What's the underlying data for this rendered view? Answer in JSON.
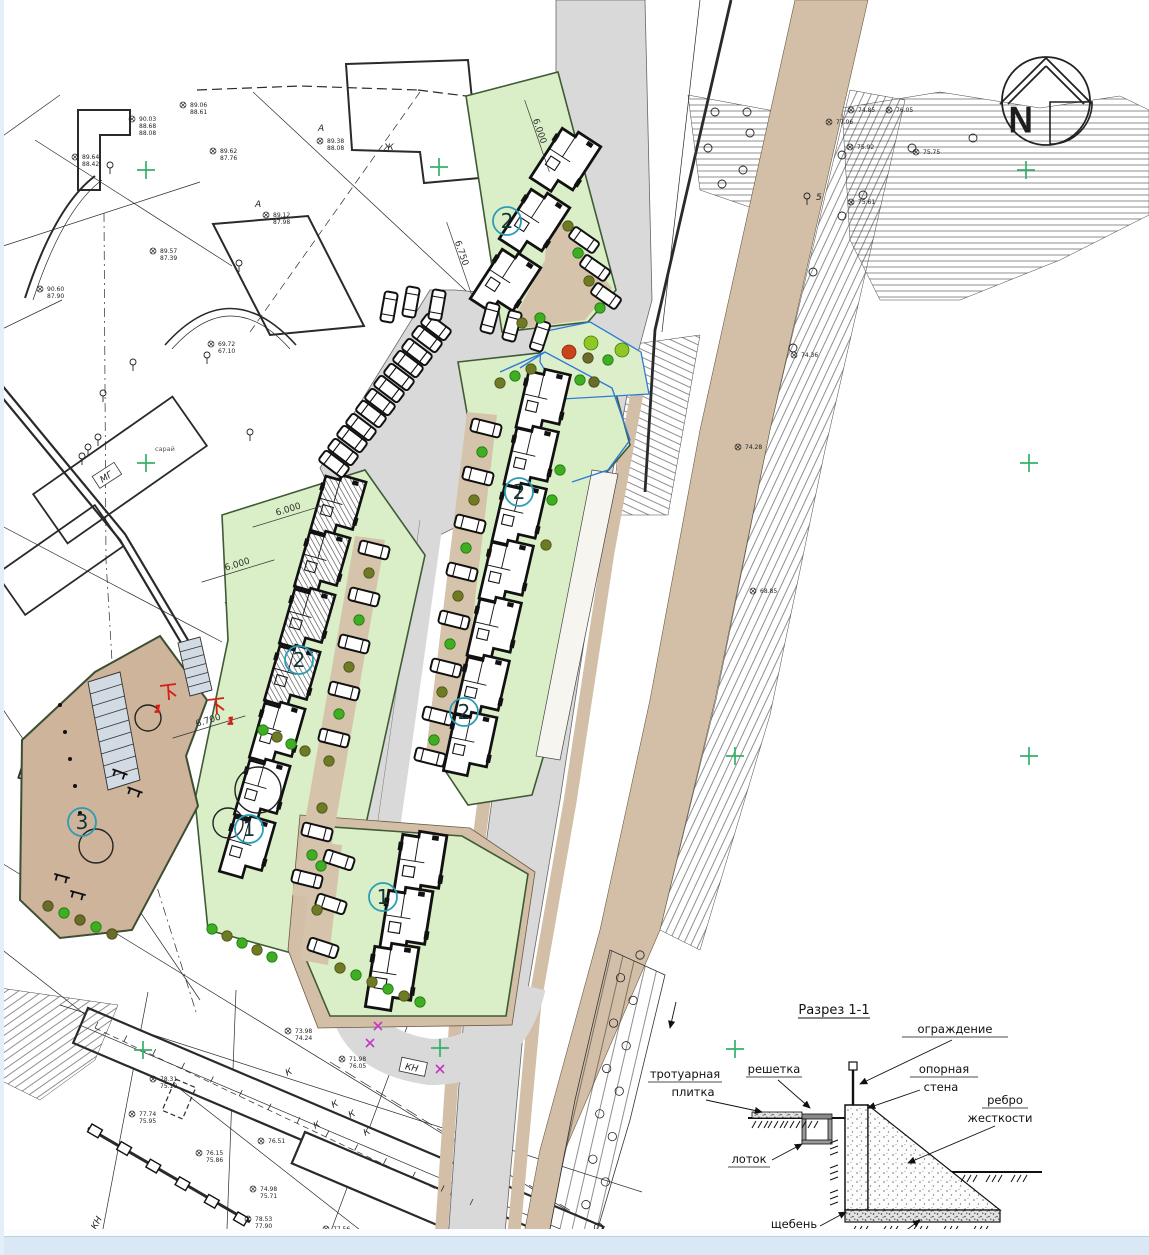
{
  "plan": {
    "north_label": "N",
    "unit_markers": [
      "2",
      "2",
      "2",
      "2",
      "1",
      "1",
      "3"
    ],
    "section_cut_marks": [
      "1",
      "1"
    ],
    "dimension_labels": [
      "6.000",
      "6.750",
      "6.000",
      "6.000",
      "6.700"
    ],
    "site_texts": {
      "zh": "Ж",
      "a1": "А",
      "a2": "А",
      "kn_box": "КН",
      "kn_slope": "КН",
      "mg": "МГ",
      "shed": "сарай",
      "tree_mark": "5"
    },
    "k_letters": [
      "К",
      "К",
      "К",
      "К",
      "К"
    ],
    "elevations": [
      {
        "lines": [
          "89.06",
          "88.61"
        ]
      },
      {
        "lines": [
          "90.03",
          "88.68",
          "88.08"
        ]
      },
      {
        "lines": [
          "89.64",
          "88.42"
        ]
      },
      {
        "lines": [
          "89.62",
          "87.76"
        ]
      },
      {
        "lines": [
          "89.38",
          "88.08"
        ]
      },
      {
        "lines": [
          "89.57",
          "87.39"
        ]
      },
      {
        "lines": [
          "89.12",
          "87.98"
        ]
      },
      {
        "lines": [
          "90.60",
          "87.90"
        ]
      },
      {
        "lines": [
          "69.72",
          "67.10"
        ]
      },
      {
        "lines": [
          "74.85"
        ]
      },
      {
        "lines": [
          "76.05"
        ]
      },
      {
        "lines": [
          "77.06"
        ]
      },
      {
        "lines": [
          "75.92"
        ]
      },
      {
        "lines": [
          "75.75"
        ]
      },
      {
        "lines": [
          "75.61"
        ]
      },
      {
        "lines": [
          "74.36"
        ]
      },
      {
        "lines": [
          "74.28"
        ]
      },
      {
        "lines": [
          "68.85"
        ]
      },
      {
        "lines": [
          "78.31",
          "75.10"
        ]
      },
      {
        "lines": [
          "77.74",
          "75.95"
        ]
      },
      {
        "lines": [
          "76.15",
          "75.86"
        ]
      },
      {
        "lines": [
          "76.51"
        ]
      },
      {
        "lines": [
          "74.98",
          "75.71"
        ]
      },
      {
        "lines": [
          "78.53",
          "77.90",
          "78.52"
        ]
      },
      {
        "lines": [
          "77.56",
          "75.62"
        ]
      },
      {
        "lines": [
          "71.98",
          "76.05"
        ]
      },
      {
        "lines": [
          "73.98",
          "74.24"
        ]
      }
    ]
  },
  "section": {
    "title": "Разрез 1-1",
    "labels": {
      "fence": "ограждение",
      "paving_line1": "тротуарная",
      "paving_line2": "плитка",
      "grate": "решетка",
      "wall_line1": "опорная",
      "wall_line2": "стена",
      "rib_line1": "ребро",
      "rib_line2": "жесткости",
      "tray": "лоток",
      "gravel": "щебень",
      "soil": "грунт"
    }
  }
}
